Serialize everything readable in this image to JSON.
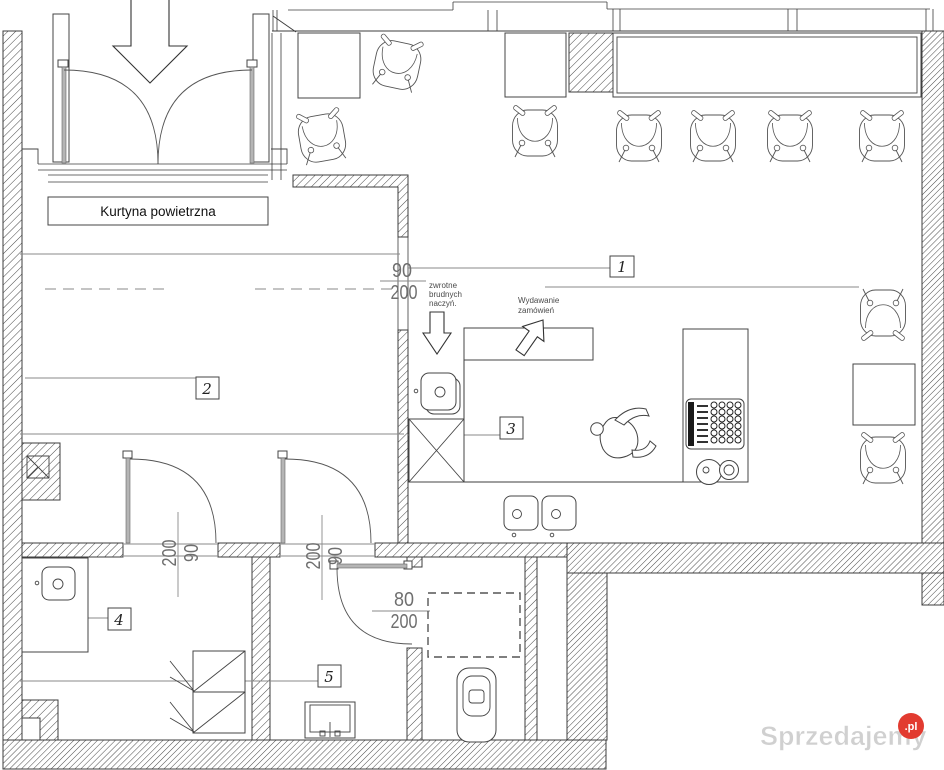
{
  "texts": {
    "air_curtain": "Kurtyna powietrzna",
    "dirty_return_1": "zwrotne",
    "dirty_return_2": "brudnych",
    "dirty_return_3": "naczyń.",
    "order_pickup_1": "Wydawanie",
    "order_pickup_2": "zamówień"
  },
  "rooms": {
    "r1": "1",
    "r2": "2",
    "r3": "3",
    "r4": "4",
    "r5": "5"
  },
  "dims": {
    "pass_w": "90",
    "pass_h": "200",
    "door4_w": "90",
    "door4_h": "200",
    "door5_w": "90",
    "door5_h": "200",
    "wc_w": "80",
    "wc_h": "200"
  },
  "watermark": {
    "name": "Sprzedajemy",
    "tld": ".pl"
  },
  "colors": {
    "line": "#3c3c3c",
    "hatch": "#474747",
    "leader": "#8a8a8a",
    "dim_text": "#6f6f6f",
    "watermark_text": "#d0d0d0",
    "watermark_badge": "#e23b30",
    "watermark_tld": "#ffffff",
    "paper": "#ffffff"
  }
}
